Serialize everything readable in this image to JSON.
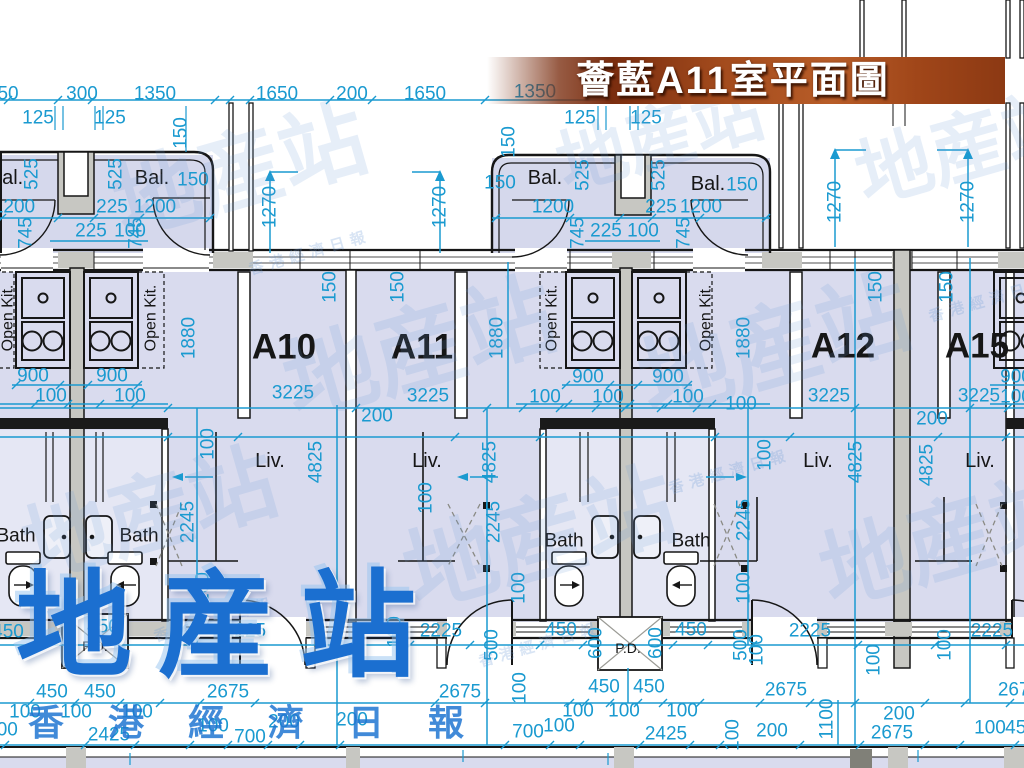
{
  "banner": {
    "title": "薈藍A11室平面圖"
  },
  "watermark": {
    "logo": "地産站",
    "subtext": "香港經濟日報",
    "ghost_big": "地産站",
    "ghost_small": "香港經濟日報",
    "ghost_marks": [
      {
        "x": 240,
        "y": 172,
        "r": -16,
        "fs": 86
      },
      {
        "x": 420,
        "y": 350,
        "r": -16,
        "fs": 92
      },
      {
        "x": 775,
        "y": 348,
        "r": -16,
        "fs": 92
      },
      {
        "x": 540,
        "y": 540,
        "r": -16,
        "fs": 92
      },
      {
        "x": 950,
        "y": 540,
        "r": -16,
        "fs": 88
      },
      {
        "x": 150,
        "y": 515,
        "r": -16,
        "fs": 86
      },
      {
        "x": 968,
        "y": 148,
        "r": -16,
        "fs": 76
      },
      {
        "x": 660,
        "y": 138,
        "r": -16,
        "fs": 70
      },
      {
        "x": 310,
        "y": 253,
        "r": -16,
        "fs": 15,
        "small": true
      },
      {
        "x": 730,
        "y": 472,
        "r": -16,
        "fs": 15,
        "small": true
      },
      {
        "x": 540,
        "y": 645,
        "r": -16,
        "fs": 15,
        "small": true
      },
      {
        "x": 990,
        "y": 300,
        "r": -16,
        "fs": 15,
        "small": true
      },
      {
        "x": 215,
        "y": 620,
        "r": -16,
        "fs": 15,
        "small": true
      }
    ]
  },
  "plan": {
    "colors": {
      "dimension": "#1a9ad0",
      "wall": "#161616",
      "wall_fill": "#c7c7c2",
      "floor": "#d9dbee",
      "bath_floor": "#e5e7f4",
      "logo_blue": "#1b6fd0",
      "banner_brown": "#a34b1d"
    },
    "unit_labels": [
      {
        "t": "A10",
        "x": 284,
        "y": 347
      },
      {
        "t": "A11",
        "x": 422,
        "y": 347
      },
      {
        "t": "A12",
        "x": 843,
        "y": 346
      },
      {
        "t": "A15",
        "x": 977,
        "y": 346
      }
    ],
    "room_labels": [
      {
        "t": "Bal.",
        "x": 6,
        "y": 178,
        "fs": 20
      },
      {
        "t": "Bal.",
        "x": 152,
        "y": 178,
        "fs": 20
      },
      {
        "t": "Bal.",
        "x": 545,
        "y": 178,
        "fs": 20
      },
      {
        "t": "Bal.",
        "x": 708,
        "y": 184,
        "fs": 20
      },
      {
        "t": "Open Kit.",
        "x": 8,
        "y": 318,
        "r": -90,
        "fs": 16
      },
      {
        "t": "Open Kit.",
        "x": 151,
        "y": 318,
        "r": -90,
        "fs": 16
      },
      {
        "t": "Open Kit.",
        "x": 552,
        "y": 318,
        "r": -90,
        "fs": 16
      },
      {
        "t": "Open Kit.",
        "x": 706,
        "y": 318,
        "r": -90,
        "fs": 16
      },
      {
        "t": "Liv.",
        "x": 270,
        "y": 461,
        "fs": 20
      },
      {
        "t": "Liv.",
        "x": 427,
        "y": 461,
        "fs": 20
      },
      {
        "t": "Liv.",
        "x": 818,
        "y": 461,
        "fs": 20
      },
      {
        "t": "Liv.",
        "x": 980,
        "y": 461,
        "fs": 20
      },
      {
        "t": "Bath",
        "x": 16,
        "y": 536,
        "fs": 19
      },
      {
        "t": "Bath",
        "x": 139,
        "y": 536,
        "fs": 19
      },
      {
        "t": "Bath",
        "x": 564,
        "y": 541,
        "fs": 19
      },
      {
        "t": "Bath",
        "x": 691,
        "y": 541,
        "fs": 19
      },
      {
        "t": "P.D.",
        "x": 95,
        "y": 646,
        "fs": 14
      },
      {
        "t": "P.D.",
        "x": 628,
        "y": 648,
        "fs": 14
      }
    ],
    "dimension_labels": [
      {
        "t": "50",
        "x": 8,
        "y": 94
      },
      {
        "t": "300",
        "x": 82,
        "y": 94
      },
      {
        "t": "1350",
        "x": 155,
        "y": 94
      },
      {
        "t": "1650",
        "x": 277,
        "y": 94
      },
      {
        "t": "200",
        "x": 352,
        "y": 94
      },
      {
        "t": "1650",
        "x": 425,
        "y": 94
      },
      {
        "t": "1350",
        "x": 535,
        "y": 92
      },
      {
        "t": "125",
        "x": 38,
        "y": 118
      },
      {
        "t": "125",
        "x": 110,
        "y": 118
      },
      {
        "t": "125",
        "x": 580,
        "y": 118
      },
      {
        "t": "125",
        "x": 646,
        "y": 118
      },
      {
        "t": "150",
        "x": 181,
        "y": 133,
        "r": -90
      },
      {
        "t": "150",
        "x": 509,
        "y": 142,
        "r": -90
      },
      {
        "t": "525",
        "x": 32,
        "y": 174,
        "r": -90
      },
      {
        "t": "525",
        "x": 116,
        "y": 174,
        "r": -90
      },
      {
        "t": "150",
        "x": 193,
        "y": 180
      },
      {
        "t": "1200",
        "x": 14,
        "y": 207
      },
      {
        "t": "225",
        "x": 112,
        "y": 207
      },
      {
        "t": "1200",
        "x": 155,
        "y": 207
      },
      {
        "t": "745",
        "x": 26,
        "y": 233,
        "r": -90
      },
      {
        "t": "225",
        "x": 91,
        "y": 231
      },
      {
        "t": "100",
        "x": 130,
        "y": 231
      },
      {
        "t": "745",
        "x": 136,
        "y": 233,
        "r": -90
      },
      {
        "t": "1270",
        "x": 270,
        "y": 207,
        "r": -90
      },
      {
        "t": "1270",
        "x": 440,
        "y": 207,
        "r": -90
      },
      {
        "t": "150",
        "x": 500,
        "y": 183
      },
      {
        "t": "525",
        "x": 583,
        "y": 175,
        "r": -90
      },
      {
        "t": "525",
        "x": 659,
        "y": 175,
        "r": -90
      },
      {
        "t": "150",
        "x": 742,
        "y": 185
      },
      {
        "t": "1200",
        "x": 553,
        "y": 207
      },
      {
        "t": "225",
        "x": 661,
        "y": 207
      },
      {
        "t": "1200",
        "x": 701,
        "y": 207
      },
      {
        "t": "745",
        "x": 578,
        "y": 233,
        "r": -90
      },
      {
        "t": "225",
        "x": 606,
        "y": 231
      },
      {
        "t": "100",
        "x": 643,
        "y": 231
      },
      {
        "t": "745",
        "x": 684,
        "y": 233,
        "r": -90
      },
      {
        "t": "1270",
        "x": 835,
        "y": 202,
        "r": -90
      },
      {
        "t": "1270",
        "x": 968,
        "y": 202,
        "r": -90
      },
      {
        "t": "150",
        "x": 330,
        "y": 287,
        "r": -90
      },
      {
        "t": "150",
        "x": 398,
        "y": 287,
        "r": -90
      },
      {
        "t": "150",
        "x": 876,
        "y": 287,
        "r": -90
      },
      {
        "t": "150",
        "x": 947,
        "y": 287,
        "r": -90
      },
      {
        "t": "1880",
        "x": 189,
        "y": 338,
        "r": -90
      },
      {
        "t": "1880",
        "x": 497,
        "y": 338,
        "r": -90
      },
      {
        "t": "1880",
        "x": 744,
        "y": 338,
        "r": -90
      },
      {
        "t": "900",
        "x": 33,
        "y": 376
      },
      {
        "t": "900",
        "x": 112,
        "y": 376
      },
      {
        "t": "900",
        "x": 588,
        "y": 377
      },
      {
        "t": "900",
        "x": 668,
        "y": 377
      },
      {
        "t": "900",
        "x": 1016,
        "y": 377
      },
      {
        "t": "100",
        "x": 51,
        "y": 396
      },
      {
        "t": "100",
        "x": 130,
        "y": 396
      },
      {
        "t": "100",
        "x": 545,
        "y": 397
      },
      {
        "t": "100",
        "x": 608,
        "y": 397
      },
      {
        "t": "100",
        "x": 688,
        "y": 397
      },
      {
        "t": "100",
        "x": 741,
        "y": 404
      },
      {
        "t": "100",
        "x": 1016,
        "y": 397
      },
      {
        "t": "3225",
        "x": 293,
        "y": 393
      },
      {
        "t": "3225",
        "x": 428,
        "y": 396
      },
      {
        "t": "3225",
        "x": 829,
        "y": 396
      },
      {
        "t": "3225",
        "x": 979,
        "y": 396
      },
      {
        "t": "200",
        "x": 377,
        "y": 416
      },
      {
        "t": "200",
        "x": 932,
        "y": 419
      },
      {
        "t": "100",
        "x": 208,
        "y": 444,
        "r": -90
      },
      {
        "t": "100",
        "x": 426,
        "y": 498,
        "r": -90
      },
      {
        "t": "100",
        "x": 765,
        "y": 455,
        "r": -90
      },
      {
        "t": "4825",
        "x": 316,
        "y": 462,
        "r": -90
      },
      {
        "t": "4825",
        "x": 490,
        "y": 462,
        "r": -90
      },
      {
        "t": "4825",
        "x": 856,
        "y": 462,
        "r": -90
      },
      {
        "t": "4825",
        "x": 927,
        "y": 465,
        "r": -90
      },
      {
        "t": "2245",
        "x": 188,
        "y": 522,
        "r": -90
      },
      {
        "t": "2245",
        "x": 494,
        "y": 522,
        "r": -90
      },
      {
        "t": "2245",
        "x": 744,
        "y": 520,
        "r": -90
      },
      {
        "t": "100",
        "x": 203,
        "y": 588,
        "r": -90
      },
      {
        "t": "100",
        "x": 519,
        "y": 588,
        "r": -90
      },
      {
        "t": "100",
        "x": 744,
        "y": 588,
        "r": -90
      },
      {
        "t": "450",
        "x": 8,
        "y": 632
      },
      {
        "t": "450",
        "x": 103,
        "y": 627
      },
      {
        "t": "2225",
        "x": 245,
        "y": 631
      },
      {
        "t": "100",
        "x": 395,
        "y": 632,
        "r": -90
      },
      {
        "t": "2225",
        "x": 441,
        "y": 631
      },
      {
        "t": "500",
        "x": 492,
        "y": 645,
        "r": -90
      },
      {
        "t": "450",
        "x": 561,
        "y": 630
      },
      {
        "t": "600",
        "x": 596,
        "y": 643,
        "r": -90
      },
      {
        "t": "600",
        "x": 656,
        "y": 643,
        "r": -90
      },
      {
        "t": "450",
        "x": 691,
        "y": 630
      },
      {
        "t": "500",
        "x": 741,
        "y": 645,
        "r": -90
      },
      {
        "t": "100",
        "x": 757,
        "y": 650,
        "r": -90
      },
      {
        "t": "2225",
        "x": 810,
        "y": 631
      },
      {
        "t": "100",
        "x": 874,
        "y": 660,
        "r": -90
      },
      {
        "t": "100",
        "x": 945,
        "y": 645,
        "r": -90
      },
      {
        "t": "2225",
        "x": 992,
        "y": 631
      },
      {
        "t": "450",
        "x": 52,
        "y": 692
      },
      {
        "t": "450",
        "x": 100,
        "y": 692
      },
      {
        "t": "2675",
        "x": 228,
        "y": 692
      },
      {
        "t": "2675",
        "x": 460,
        "y": 692
      },
      {
        "t": "450",
        "x": 604,
        "y": 687
      },
      {
        "t": "450",
        "x": 649,
        "y": 687
      },
      {
        "t": "2675",
        "x": 786,
        "y": 690
      },
      {
        "t": "2675",
        "x": 1019,
        "y": 690
      },
      {
        "t": "1100",
        "x": 827,
        "y": 719,
        "r": -90
      },
      {
        "t": "100",
        "x": 520,
        "y": 688,
        "r": -90
      },
      {
        "t": "100",
        "x": 25,
        "y": 712
      },
      {
        "t": "100",
        "x": 76,
        "y": 712
      },
      {
        "t": "100",
        "x": 137,
        "y": 712
      },
      {
        "t": "100",
        "x": 578,
        "y": 711
      },
      {
        "t": "100",
        "x": 624,
        "y": 711
      },
      {
        "t": "100",
        "x": 682,
        "y": 711
      },
      {
        "t": "200",
        "x": 899,
        "y": 714
      },
      {
        "t": "400",
        "x": 2,
        "y": 730
      },
      {
        "t": "2425",
        "x": 109,
        "y": 735
      },
      {
        "t": "100",
        "x": 213,
        "y": 726
      },
      {
        "t": "700",
        "x": 250,
        "y": 737
      },
      {
        "t": "200",
        "x": 284,
        "y": 722
      },
      {
        "t": "200",
        "x": 352,
        "y": 720
      },
      {
        "t": "700",
        "x": 528,
        "y": 732
      },
      {
        "t": "100",
        "x": 559,
        "y": 726
      },
      {
        "t": "2425",
        "x": 666,
        "y": 734
      },
      {
        "t": "100",
        "x": 733,
        "y": 735,
        "r": -90
      },
      {
        "t": "200",
        "x": 772,
        "y": 731
      },
      {
        "t": "2675",
        "x": 892,
        "y": 733
      },
      {
        "t": "100",
        "x": 990,
        "y": 728
      },
      {
        "t": "450",
        "x": 1021,
        "y": 728
      }
    ]
  }
}
